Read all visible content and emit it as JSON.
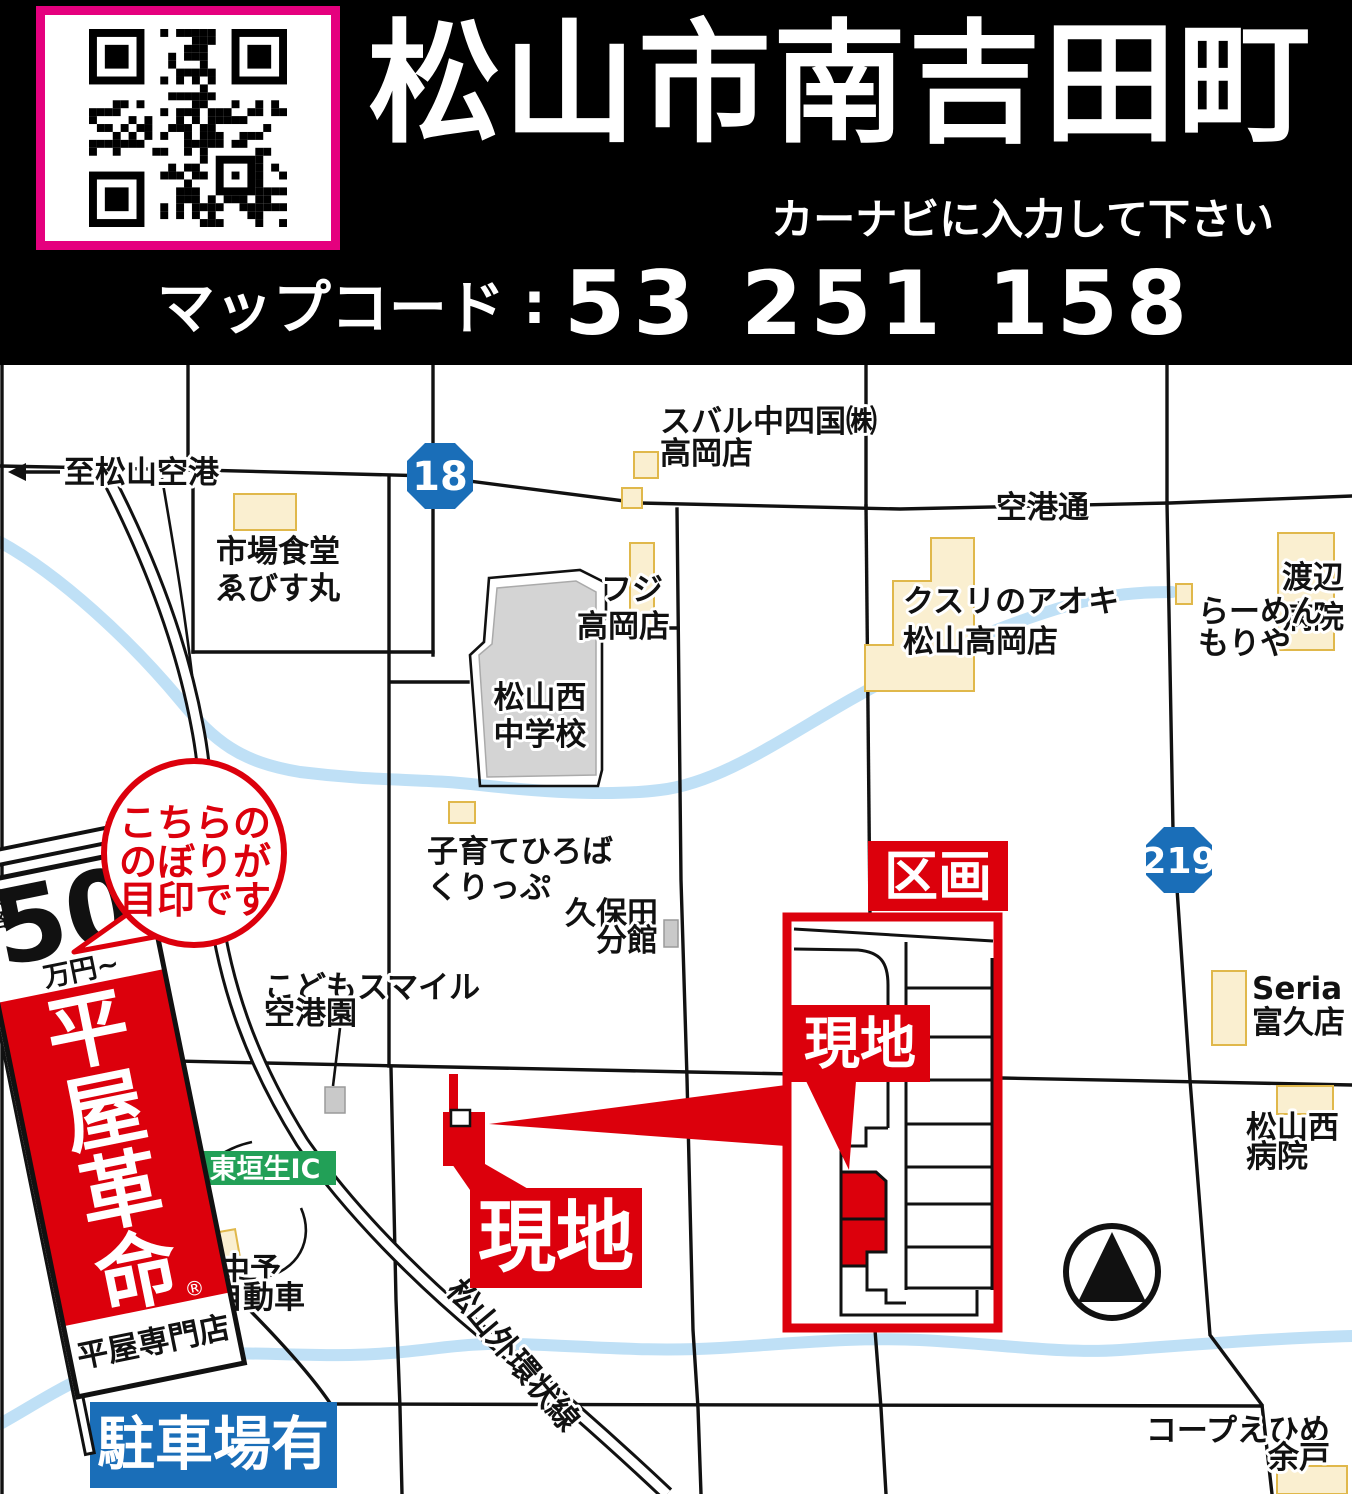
{
  "header": {
    "title": "松山市南吉田町",
    "subtitle": "カーナビに入力して下さい",
    "mapcode_label": "マップコード",
    "mapcode_sep": ":",
    "mapcode_value": "53 251 158"
  },
  "map": {
    "route_badges": {
      "r18": "18",
      "r219": "219"
    },
    "road_labels": {
      "to_airport": "至松山空港",
      "kukoudori": "空港通",
      "gaikan": "松山外環状線"
    },
    "landmarks": {
      "subaru": [
        "スバル中四国㈱",
        "高岡店"
      ],
      "ichiba": [
        "市場食堂",
        "ゑびす丸"
      ],
      "fuji": [
        "フジ",
        "高岡店"
      ],
      "kusuri": [
        "クスリのアオキ",
        "松山高岡店"
      ],
      "watanabe": [
        "渡辺",
        "病院"
      ],
      "ramen": [
        "らーめん",
        "もりや"
      ],
      "school": [
        "松山西",
        "中学校"
      ],
      "kosodate": [
        "子育てひろば",
        "くりっぷ"
      ],
      "kubota": [
        "久保田",
        "分館"
      ],
      "kodomo": [
        "こどもスマイル",
        "空港園"
      ],
      "chuyo": [
        "中予",
        "自動車"
      ],
      "seria": [
        "Seria",
        "富久店"
      ],
      "nishibyoin": [
        "松山西",
        "病院"
      ],
      "coop": [
        "コープえひめ",
        "余戸"
      ]
    },
    "ic_badge": "東垣生IC",
    "parking_badge": "駐車場有",
    "site_label": "現地",
    "inset": {
      "kukaku_label": "区画",
      "site_label": "現地"
    },
    "bubble_lines": [
      "こちらの",
      "のぼりが",
      "目印です"
    ],
    "banner": {
      "price_prefix_chars": [
        "価",
        "格"
      ],
      "price_number": "50",
      "price_unit": "万円~",
      "brand_chars": [
        "平",
        "屋",
        "革",
        "命"
      ],
      "reg_mark": "®",
      "brand_sub": "平屋専門店"
    }
  },
  "colors": {
    "accent_red": "#DC000C",
    "route_blue": "#1A6EB8",
    "ic_green": "#22A057",
    "qr_frame_pink": "#E5007E",
    "building_yellow": "#FAEFD0",
    "river_blue": "#BFE0F6"
  }
}
